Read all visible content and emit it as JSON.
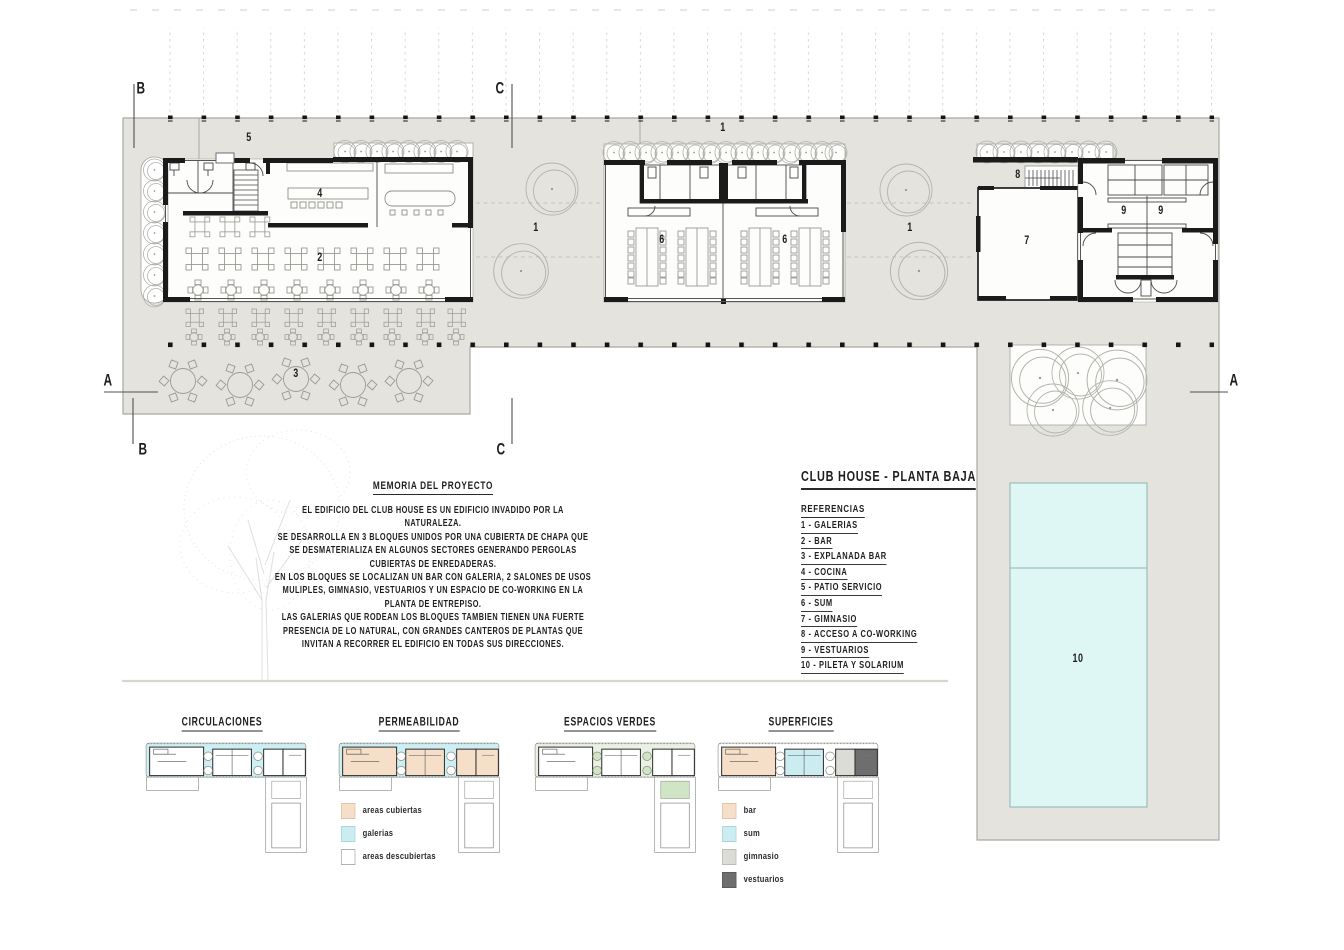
{
  "title_block": {
    "title": "CLUB HOUSE - PLANTA BAJA"
  },
  "referencias": {
    "heading": "REFERENCIAS",
    "items": [
      "1 - GALERIAS",
      "2 - BAR",
      "3 - EXPLANADA BAR",
      "4 - COCINA",
      "5 - PATIO SERVICIO",
      "6 - SUM",
      "7 - GIMNASIO",
      "8 - ACCESO A CO-WORKING",
      "9 - VESTUARIOS",
      "10 - PILETA Y SOLARIUM"
    ]
  },
  "memoria": {
    "heading": "MEMORIA DEL PROYECTO",
    "body": "EL EDIFICIO DEL CLUB HOUSE ES UN EDIFICIO INVADIDO POR LA\nNATURALEZA.\nSE DESARROLLA EN 3 BLOQUES UNIDOS POR UNA CUBIERTA DE CHAPA QUE\nSE DESMATERIALIZA EN ALGUNOS SECTORES GENERANDO PERGOLAS\nCUBIERTAS DE ENREDADERAS.\nEN LOS BLOQUES  SE LOCALIZAN UN BAR CON GALERIA, 2 SALONES DE USOS\nMULIPLES, GIMNASIO, VESTUARIOS Y UN ESPACIO DE CO-WORKING EN LA\nPLANTA DE ENTREPISO.\nLAS GALERIAS QUE RODEAN LOS BLOQUES TAMBIEN TIENEN UNA FUERTE\nPRESENCIA DE LO NATURAL, CON GRANDES CANTEROS DE PLANTAS QUE\nINVITAN A RECORRER EL EDIFICIO EN TODAS SUS DIRECCIONES."
  },
  "plan": {
    "num_1": "1",
    "num_2": "2",
    "num_3": "3",
    "num_4": "4",
    "num_5": "5",
    "num_6": "6",
    "num_7": "7",
    "num_8": "8",
    "num_9": "9",
    "num_10": "10",
    "section_a": "A",
    "section_b": "B",
    "section_c": "C"
  },
  "diagrams": {
    "circulaciones": {
      "title": "CIRCULACIONES"
    },
    "permeabilidad": {
      "title": "PERMEABILIDAD",
      "legend": [
        {
          "label": "areas cubiertas",
          "color": "#f6dfc9"
        },
        {
          "label": "galerias",
          "color": "#cbedf2"
        },
        {
          "label": "areas descubiertas",
          "color": "#ffffff"
        }
      ]
    },
    "espacios_verdes": {
      "title": "ESPACIOS VERDES"
    },
    "superficies": {
      "title": "SUPERFICIES",
      "legend": [
        {
          "label": "bar",
          "color": "#f6dfc9"
        },
        {
          "label": "sum",
          "color": "#cbedf2"
        },
        {
          "label": "gimnasio",
          "color": "#dcdcd6"
        },
        {
          "label": "vestuarios",
          "color": "#6e6e6e"
        }
      ]
    }
  },
  "colors": {
    "site": "#e4e3de",
    "pool": "#def6f4",
    "wall": "#1b1b1b",
    "accent_cyan": "#cbedf2",
    "accent_peach": "#f6dfc9",
    "accent_green": "#cfe5c3"
  }
}
